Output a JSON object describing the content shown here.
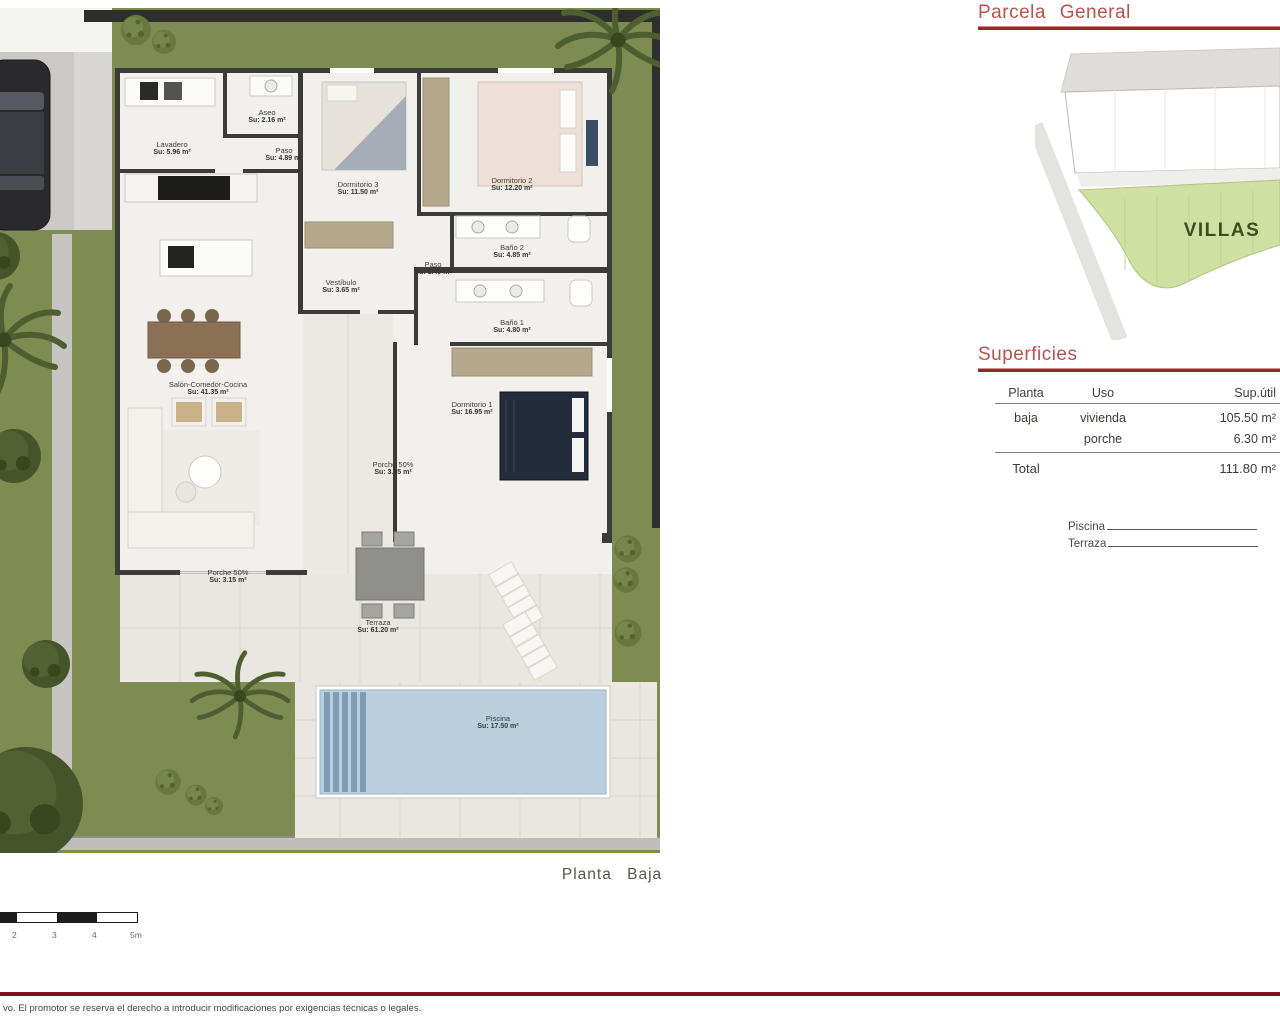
{
  "plan": {
    "caption": "Planta Baja",
    "rooms": [
      {
        "name": "Lavadero",
        "area": "Su: 5.96 m²"
      },
      {
        "name": "Aseo",
        "area": "Su: 2.16 m²"
      },
      {
        "name": "Paso",
        "area": "Su: 4.89 m²"
      },
      {
        "name": "Dormitorio 3",
        "area": "Su: 11.50 m²"
      },
      {
        "name": "Dormitorio 2",
        "area": "Su: 12.20 m²"
      },
      {
        "name": "Baño 2",
        "area": "Su: 4.85 m²"
      },
      {
        "name": "Paso",
        "area": "Su: 1.40 m²"
      },
      {
        "name": "Baño 1",
        "area": "Su: 4.80 m²"
      },
      {
        "name": "Vestíbulo",
        "area": "Su: 3.65 m²"
      },
      {
        "name": "Salón-Comedor-Cocina",
        "area": "Su: 41.35 m²"
      },
      {
        "name": "Dormitorio 1",
        "area": "Su: 16.95 m²"
      },
      {
        "name": "Porche 50%",
        "area": "Su: 3.15 m²"
      },
      {
        "name": "Porche 50%",
        "area": "Su: 3.15 m²"
      },
      {
        "name": "Terraza",
        "area": "Su: 61.20 m²"
      },
      {
        "name": "Piscina",
        "area": "Su: 17.50 m²"
      }
    ],
    "scale": {
      "labels": [
        "2",
        "3",
        "4",
        "5m"
      ]
    }
  },
  "parcela": {
    "title": "Parcela General",
    "zone_label": "VILLAS"
  },
  "superficies": {
    "title": "Superficies",
    "headers": [
      "Planta",
      "Uso",
      "Sup.útil"
    ],
    "rows": [
      {
        "planta": "baja",
        "uso": "vivienda",
        "sup": "105.50 m²"
      },
      {
        "planta": "",
        "uso": "porche",
        "sup": "6.30 m²"
      }
    ],
    "total_label": "Total",
    "total_value": "111.80 m²",
    "fill_ins": [
      "Piscina",
      "Terraza"
    ]
  },
  "footer": {
    "disclaimer": "vo. El promotor se reserva el derecho a introducir modificaciones por exigencias técnicas o legales."
  },
  "colors": {
    "heading": "#b8534d",
    "heading_rule": "#8f2b26",
    "footer_rule": "#7d1316",
    "grass": "#7e8c52",
    "pool_water": "#b9cfdd",
    "villas_green": "#cfe1a2"
  }
}
